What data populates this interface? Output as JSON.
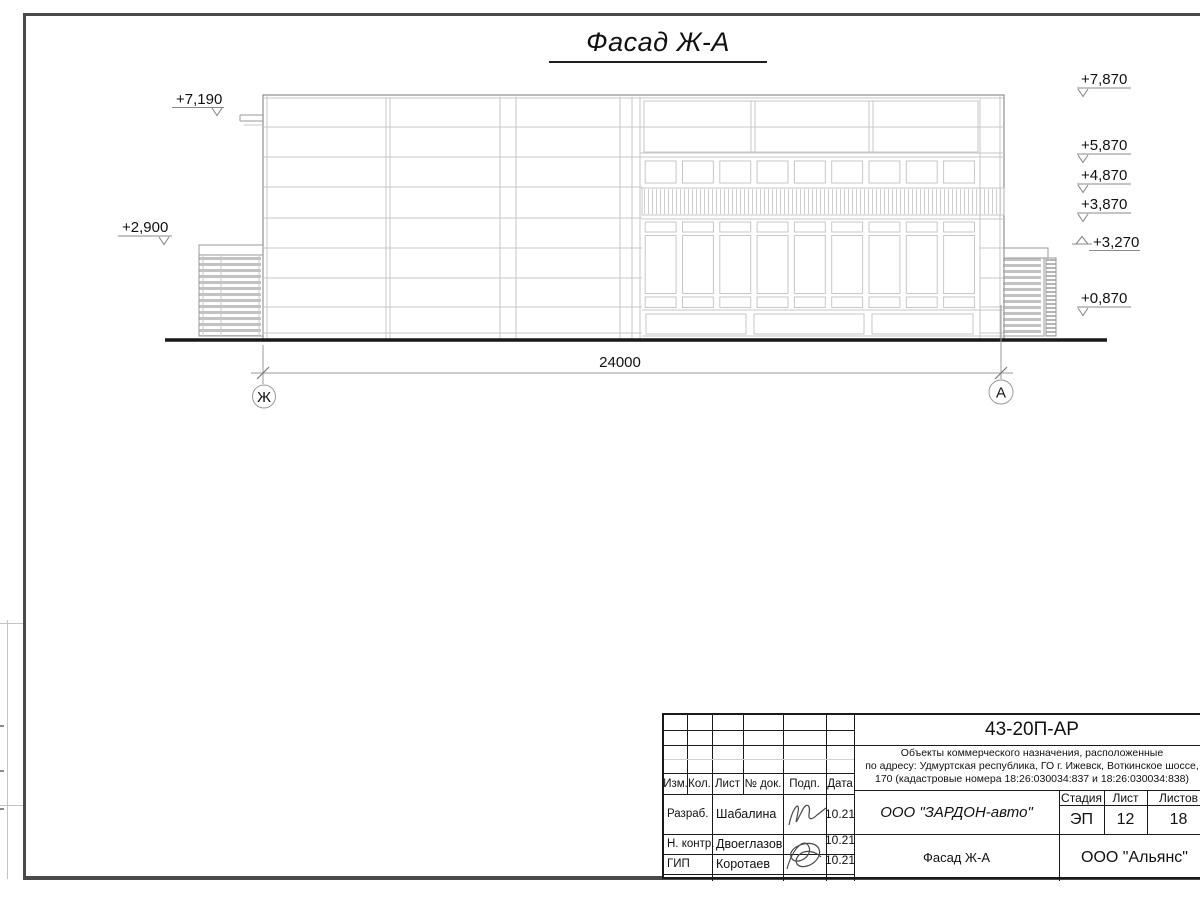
{
  "drawing": {
    "title": "Фасад Ж-А",
    "dimension_label": "24000",
    "axis_left_label": "Ж",
    "axis_right_label": "А",
    "elev_left_top": "+7,190",
    "elev_left_mid": "+2,900",
    "elev_r1": "+7,870",
    "elev_r2": "+5,870",
    "elev_r3": "+4,870",
    "elev_r4": "+3,870",
    "elev_r5": "+3,270",
    "elev_r6": "+0,870"
  },
  "title_block": {
    "doc_code": "43-20П-АР",
    "project_line1": "Объекты коммерческого назначения, расположенные",
    "project_line2": "по адресу: Удмуртская республика, ГО г. Ижевск, Воткинское шоссе,",
    "project_line3": "170 (кадастровые номера 18:26:030034:837 и 18:26:030034:838)",
    "col_izm": "Изм.",
    "col_kol": "Кол.",
    "col_list": "Лист",
    "col_doc": "№ док.",
    "col_podp": "Подп.",
    "col_data": "Дата",
    "stage_header": "Стадия",
    "sheet_header": "Лист",
    "sheets_header": "Листов",
    "stage_value": "ЭП",
    "sheet_value": "12",
    "sheets_value": "18",
    "rows": [
      {
        "role": "Разраб.",
        "name": "Шабалина",
        "date": "10.21"
      },
      {
        "role": "Н. контр.",
        "name": "Двоеглазов",
        "date": "10.21"
      },
      {
        "role": "ГИП",
        "name": "Коротаев",
        "date": "10.21"
      }
    ],
    "company": "ООО \"ЗАРДОН-авто\"",
    "object_name": "Фасад Ж-А",
    "org": "ООО \"Альянс\""
  }
}
